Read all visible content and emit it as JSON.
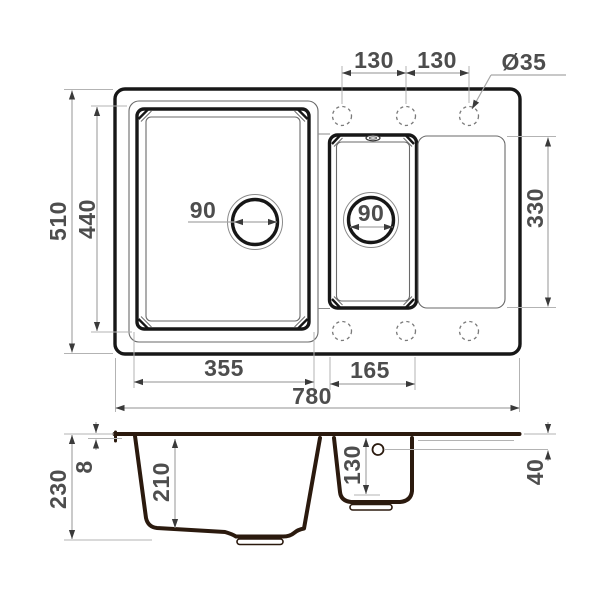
{
  "drawing": {
    "kind": "kitchen-sink-technical-dimension-drawing",
    "units": "mm",
    "colors": {
      "background": "#ffffff",
      "top_view_outline": "#171717",
      "section_outline": "#2b1a0e",
      "dimension_text": "#4d4d4d",
      "dimension_lines": "#a6a6a6"
    },
    "top_view": {
      "overall": {
        "width": "780",
        "depth": "510"
      },
      "faucet_holes": {
        "spacing_left": "130",
        "spacing_right": "130",
        "diameter": "Ø35",
        "count_visible": 6
      },
      "main_bowl": {
        "width": "355",
        "depth": "440",
        "drain_diameter": "90"
      },
      "small_bowl": {
        "width": "165",
        "drain_diameter": "90"
      },
      "drainboard": {
        "length": "330"
      }
    },
    "section_view": {
      "overall_height": "230",
      "rim_thickness": "8",
      "main_bowl_depth": "210",
      "small_bowl_depth": "130",
      "drainboard_drop": "40"
    }
  }
}
